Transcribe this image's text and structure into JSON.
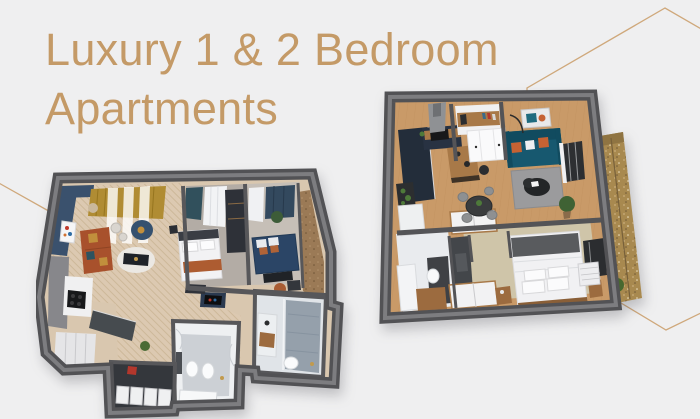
{
  "title": {
    "line1": "Luxury 1 & 2 Bedroom",
    "line2": "Apartments"
  },
  "colors": {
    "background": "#efeff0",
    "title_text": "#c49a67",
    "decor_lines": "#cfa87b",
    "plan_walls": "#58585b",
    "wood_floor": "#c99a68",
    "herringbone_floor": "#dcc9b1",
    "navy_accent": "#3a516d",
    "rust_accent": "#a8512c",
    "mustard_accent": "#b08c33",
    "teal_sofa": "#17586f",
    "balcony_wood": "#a8894f"
  },
  "floor_plans": [
    {
      "id": "two-bedroom",
      "label": "2 bedroom apartment 3D floor plan"
    },
    {
      "id": "one-bedroom",
      "label": "1 bedroom apartment 3D floor plan"
    }
  ]
}
